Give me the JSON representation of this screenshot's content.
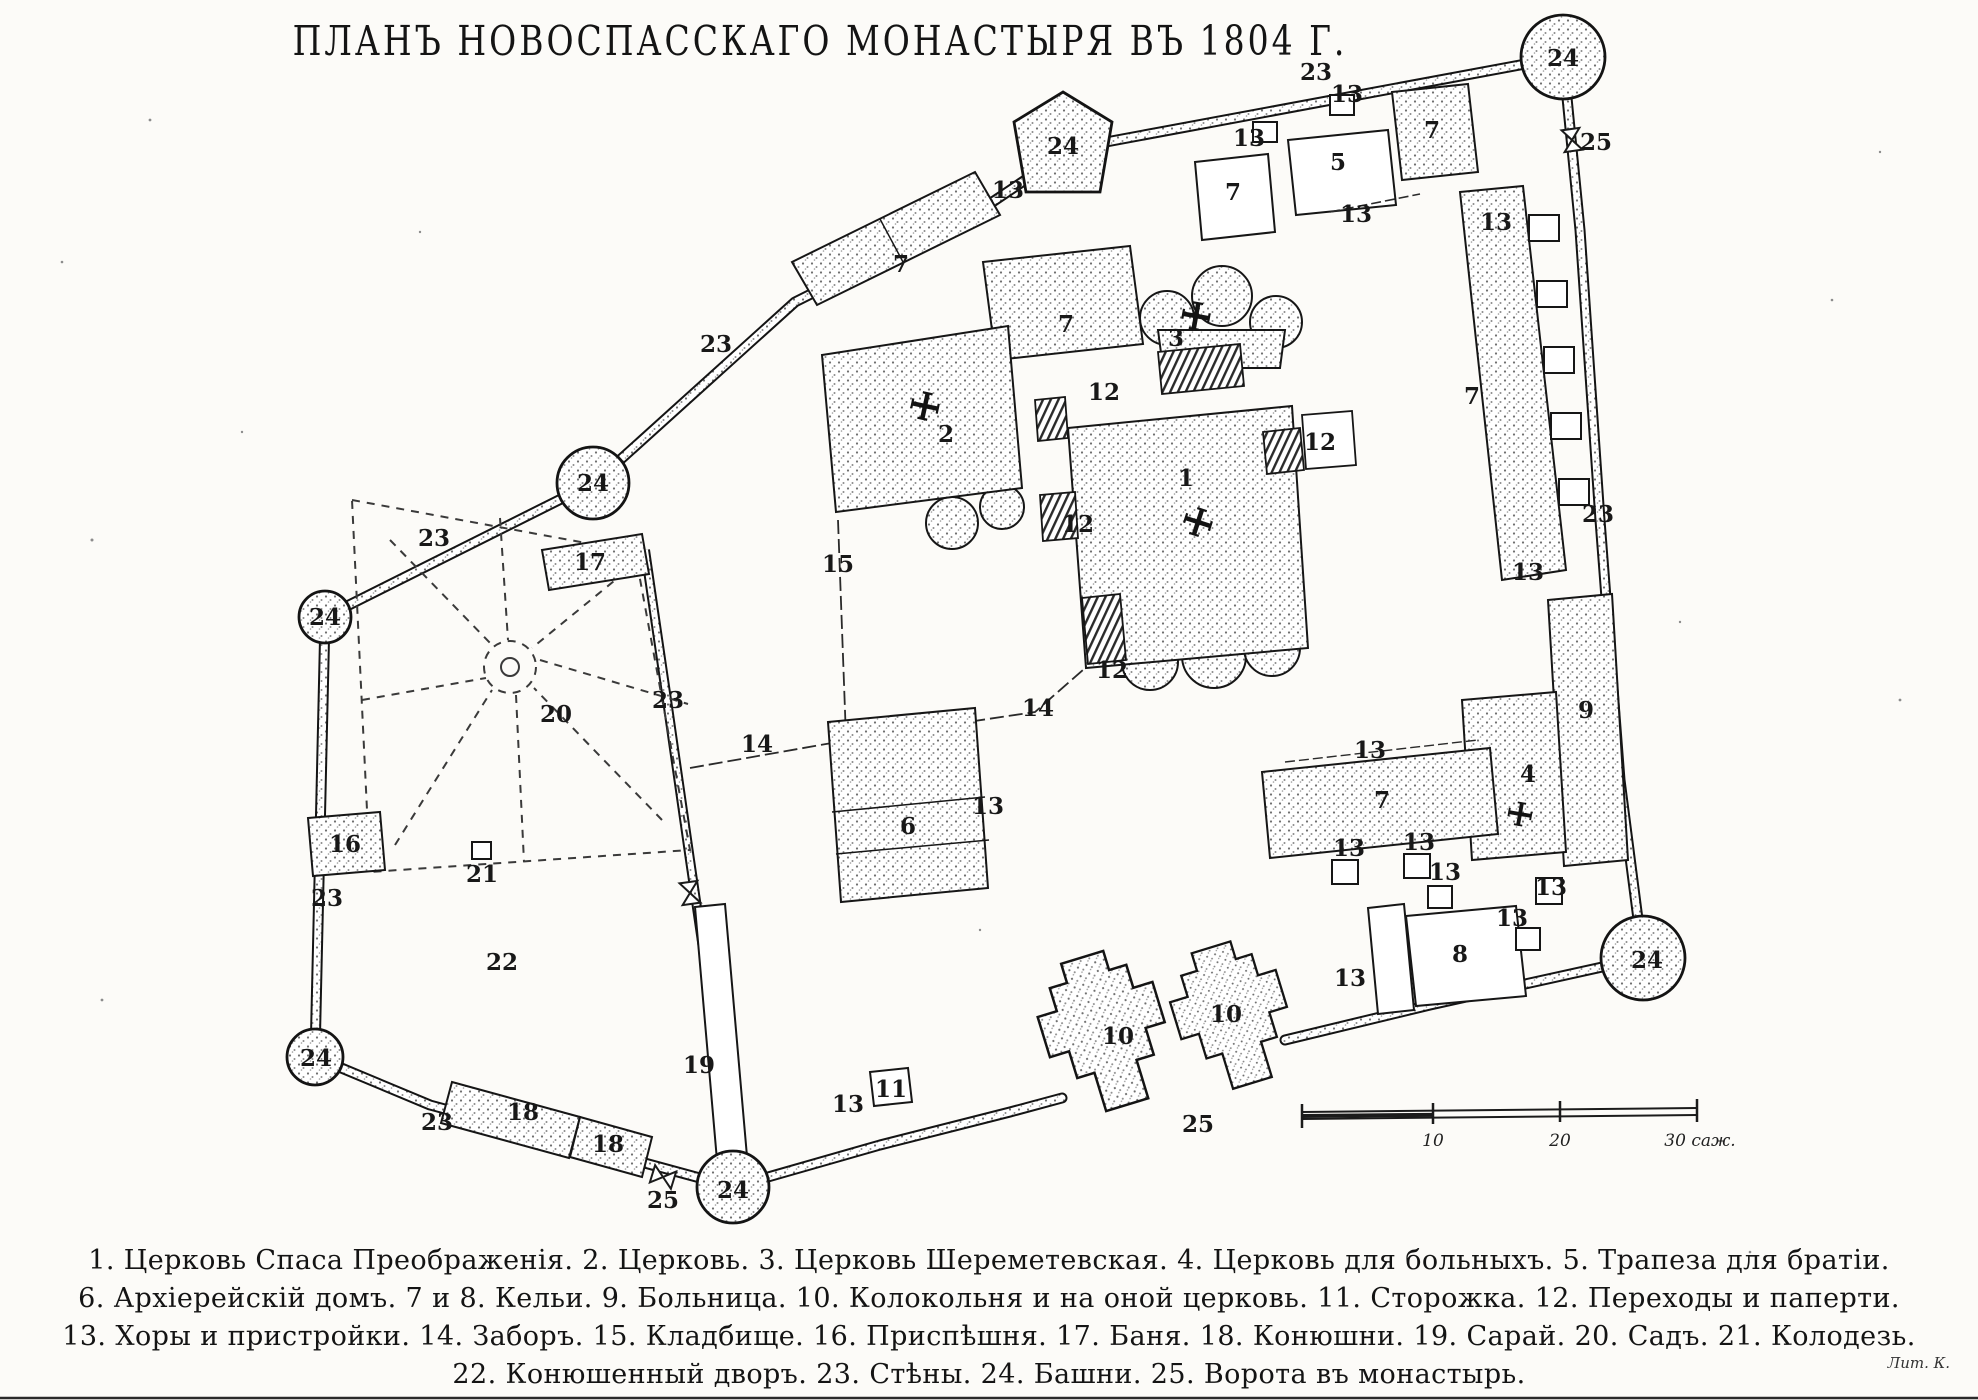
{
  "title": "ПЛАНЪ НОВОСПАССКАГО МОНАСТЫРЯ ВЪ 1804 Г.",
  "legend": {
    "lines": [
      "1. Церковь Спаса Преображенія.  2. Церковь.  3. Церковь Шереметевская.  4. Церковь для больныхъ.  5. Трапеза для братіи.",
      "6. Архіерейскій домъ.  7 и 8. Кельи.  9. Больница.  10. Колокольня и на оной церковь.  11. Сторожка.  12. Переходы и паперти.",
      "13. Хоры и пристройки.  14. Заборъ.  15. Кладбище.  16. Приспѣшня.  17. Баня.  18. Конюшни.  19. Сарай.  20. Садъ.  21. Колодезь.",
      "22. Конюшенный дворъ.  23. Стѣны.  24. Башни.  25. Ворота въ монастырь."
    ]
  },
  "scale_bar": {
    "unit": "саж.",
    "ticks": [
      "10",
      "20",
      "30 саж."
    ]
  },
  "printer_mark": "Лит. К.",
  "colors": {
    "paper": "#fcfbf8",
    "ink": "#1b1b1b"
  },
  "map_labels": [
    {
      "t": "24",
      "x": 1563,
      "y": 66
    },
    {
      "t": "23",
      "x": 1316,
      "y": 80
    },
    {
      "t": "25",
      "x": 1596,
      "y": 150
    },
    {
      "t": "24",
      "x": 1063,
      "y": 154
    },
    {
      "t": "13",
      "x": 1008,
      "y": 198
    },
    {
      "t": "7",
      "x": 901,
      "y": 272
    },
    {
      "t": "23",
      "x": 716,
      "y": 352
    },
    {
      "t": "13",
      "x": 1249,
      "y": 146
    },
    {
      "t": "7",
      "x": 1233,
      "y": 200
    },
    {
      "t": "13",
      "x": 1347,
      "y": 102
    },
    {
      "t": "5",
      "x": 1338,
      "y": 170
    },
    {
      "t": "7",
      "x": 1432,
      "y": 138
    },
    {
      "t": "13",
      "x": 1356,
      "y": 222
    },
    {
      "t": "13",
      "x": 1496,
      "y": 230
    },
    {
      "t": "7",
      "x": 1472,
      "y": 404
    },
    {
      "t": "23",
      "x": 1598,
      "y": 522
    },
    {
      "t": "13",
      "x": 1528,
      "y": 580
    },
    {
      "t": "9",
      "x": 1586,
      "y": 718
    },
    {
      "t": "4",
      "x": 1528,
      "y": 782
    },
    {
      "t": "7",
      "x": 1382,
      "y": 808
    },
    {
      "t": "13",
      "x": 1370,
      "y": 758
    },
    {
      "t": "13",
      "x": 1349,
      "y": 856
    },
    {
      "t": "13",
      "x": 1419,
      "y": 850
    },
    {
      "t": "13",
      "x": 1445,
      "y": 880
    },
    {
      "t": "13",
      "x": 1512,
      "y": 926
    },
    {
      "t": "13",
      "x": 1551,
      "y": 895
    },
    {
      "t": "8",
      "x": 1460,
      "y": 962
    },
    {
      "t": "13",
      "x": 1350,
      "y": 986
    },
    {
      "t": "24",
      "x": 1647,
      "y": 968
    },
    {
      "t": "10",
      "x": 1118,
      "y": 1044
    },
    {
      "t": "10",
      "x": 1226,
      "y": 1022
    },
    {
      "t": "25",
      "x": 1198,
      "y": 1132
    },
    {
      "t": "13",
      "x": 848,
      "y": 1112
    },
    {
      "t": "11",
      "x": 891,
      "y": 1097
    },
    {
      "t": "1",
      "x": 1186,
      "y": 486
    },
    {
      "t": "3",
      "x": 1176,
      "y": 346
    },
    {
      "t": "2",
      "x": 946,
      "y": 442
    },
    {
      "t": "12",
      "x": 1104,
      "y": 400
    },
    {
      "t": "12",
      "x": 1320,
      "y": 450
    },
    {
      "t": "12",
      "x": 1078,
      "y": 532
    },
    {
      "t": "12",
      "x": 1112,
      "y": 678
    },
    {
      "t": "7",
      "x": 1066,
      "y": 332
    },
    {
      "t": "15",
      "x": 838,
      "y": 572
    },
    {
      "t": "14",
      "x": 757,
      "y": 752
    },
    {
      "t": "14",
      "x": 1038,
      "y": 716
    },
    {
      "t": "6",
      "x": 908,
      "y": 834
    },
    {
      "t": "13",
      "x": 988,
      "y": 814
    },
    {
      "t": "23",
      "x": 668,
      "y": 708
    },
    {
      "t": "24",
      "x": 593,
      "y": 491
    },
    {
      "t": "23",
      "x": 434,
      "y": 546
    },
    {
      "t": "17",
      "x": 590,
      "y": 570
    },
    {
      "t": "20",
      "x": 556,
      "y": 722
    },
    {
      "t": "24",
      "x": 325,
      "y": 625
    },
    {
      "t": "16",
      "x": 345,
      "y": 852
    },
    {
      "t": "21",
      "x": 482,
      "y": 882
    },
    {
      "t": "23",
      "x": 327,
      "y": 906
    },
    {
      "t": "22",
      "x": 502,
      "y": 970
    },
    {
      "t": "24",
      "x": 316,
      "y": 1066
    },
    {
      "t": "23",
      "x": 437,
      "y": 1130
    },
    {
      "t": "18",
      "x": 523,
      "y": 1120
    },
    {
      "t": "18",
      "x": 608,
      "y": 1152
    },
    {
      "t": "19",
      "x": 699,
      "y": 1073
    },
    {
      "t": "25",
      "x": 663,
      "y": 1208
    },
    {
      "t": "24",
      "x": 733,
      "y": 1198
    }
  ]
}
